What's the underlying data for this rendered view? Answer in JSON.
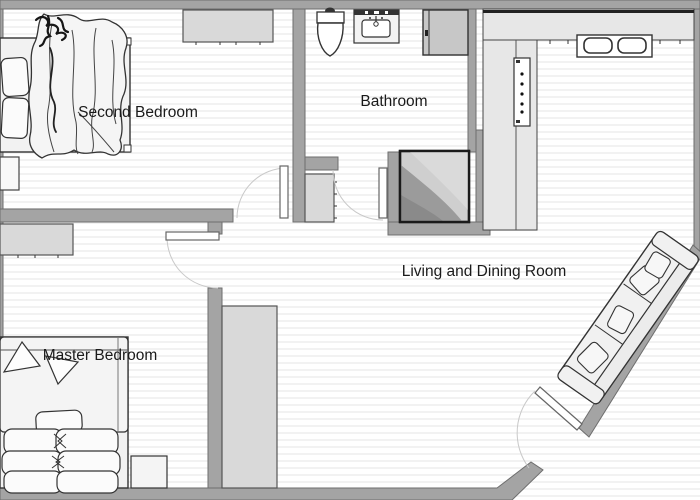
{
  "rooms": {
    "second_bedroom": {
      "label": "Second Bedroom"
    },
    "bathroom": {
      "label": "Bathroom"
    },
    "living_dining": {
      "label": "Living and Dining Room"
    },
    "master_bedroom": {
      "label": "Master Bedroom"
    }
  },
  "fixtures": [
    "bed",
    "blanket",
    "pillow",
    "desk",
    "nightstand",
    "dresser",
    "hall-cabinet",
    "toilet",
    "bathroom-sink",
    "shower",
    "bathroom-shelf",
    "kitchen-counter",
    "kitchen-double-sink",
    "oven-panel",
    "sideboard",
    "sofa",
    "door-swing",
    "entrance-door"
  ],
  "theme": {
    "wall": "#a4a4a4",
    "wall-edge": "#6e6e6e",
    "furniture": "#d9d9d9",
    "counter": "#e7e7e7",
    "floor-stripe": "#f2f2f2",
    "text": "#1a1a1a"
  }
}
